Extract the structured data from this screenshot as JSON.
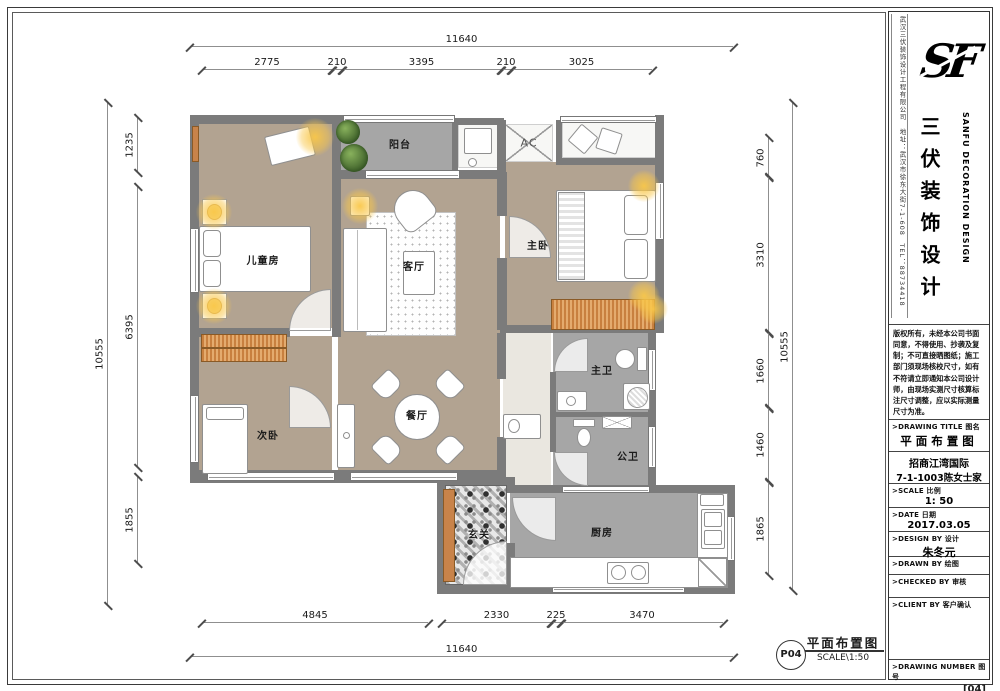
{
  "rooms": {
    "kids": "儿童房",
    "balcony": "阳台",
    "master": "主卧",
    "living": "客厅",
    "second": "次卧",
    "dining": "餐厅",
    "master_bath": "主卫",
    "public_bath": "公卫",
    "kitchen": "厨房",
    "entry": "玄关",
    "ac": "AC"
  },
  "dims": {
    "top_total": "11640",
    "top": [
      "2775",
      "210",
      "3395",
      "210",
      "3025"
    ],
    "left_total": "10555",
    "left": [
      "1235",
      "6395",
      "1855"
    ],
    "right_total": "10555",
    "right": [
      "760",
      "3310",
      "1660",
      "1460",
      "1865"
    ],
    "bottom": [
      "4845",
      "2330",
      "225",
      "3470"
    ],
    "bottom_total": "11640"
  },
  "stamp": {
    "code": "P04",
    "title": "平面布置图",
    "scale": "SCALE\\1:50"
  },
  "title_block": {
    "side_info": "武汉三伏装饰设计工程有限公司　地址：武汉市徐东大街7-1-608　TEL：88734418",
    "logo": "SF",
    "company_cn": "三伏装饰设计",
    "company_en": "SANFU DECORATION DESIGN",
    "copyright": "版权所有，未经本公司书面同意，不得使用、抄袭及复制；不可直接晒图纸；施工部门须现场核校尺寸，如有不符请立即通知本公司设计师，由现场实测尺寸核算标注尺寸调整，应以实际测量尺寸为准。",
    "drawing_title_label": ">DRAWING TITLE 图名",
    "drawing_title": "平面布置图",
    "project_line1": "招商江湾国际",
    "project_line2": "7-1-1003陈女士家",
    "scale_label": ">SCALE 比例",
    "scale_value": "1: 50",
    "date_label": ">DATE 日期",
    "date_value": "2017.03.05",
    "design_label": ">DESIGN BY 设计",
    "design_value": "朱冬元",
    "drawn_label": ">DRAWN BY 绘图",
    "checked_label": ">CHECKED BY 审核",
    "client_label": ">CLIENT BY 客户确认",
    "number_label": ">DRAWING NUMBER 图号",
    "number_value": "[04]"
  }
}
